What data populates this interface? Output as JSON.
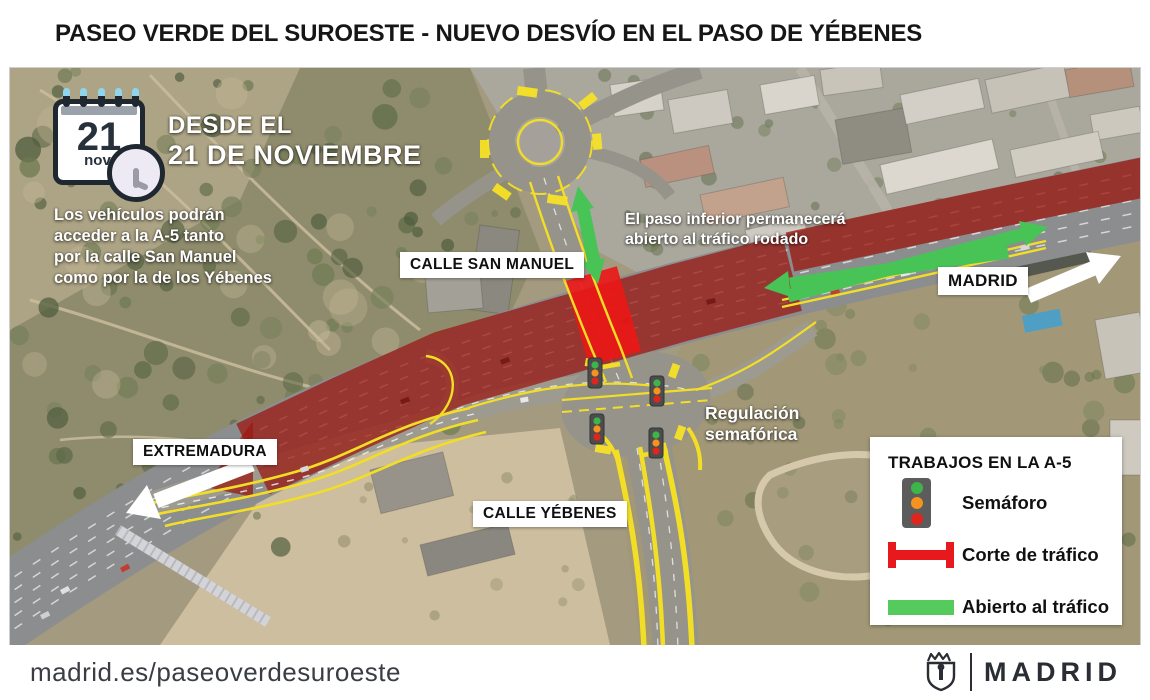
{
  "title": "PASEO VERDE DEL SUROESTE - NUEVO DESVÍO EN EL PASO DE YÉBENES",
  "calendar": {
    "day": "21",
    "month": "nov."
  },
  "date_heading": {
    "line1": "DESDE EL",
    "line2": "21 DE NOVIEMBRE"
  },
  "info_left": {
    "lines": [
      "Los vehículos podrán",
      "acceder a la A-5 tanto",
      "por la calle San Manuel",
      "como por la de los Yébenes"
    ]
  },
  "underpass_note": {
    "lines": [
      "El paso inferior permanecerá",
      "abierto al tráfico rodado"
    ]
  },
  "signal_note": {
    "lines": [
      "Regulación",
      "semafórica"
    ]
  },
  "map_labels": {
    "calle_san_manuel": "CALLE SAN MANUEL",
    "madrid": "MADRID",
    "extremadura": "EXTREMADURA",
    "calle_yebenes": "CALLE YÉBENES"
  },
  "legend": {
    "title": "TRABAJOS EN LA A-5",
    "items": [
      {
        "icon": "traffic-light-icon",
        "label": "Semáforo"
      },
      {
        "icon": "road-closed-bar-icon",
        "label": "Corte de tráfico"
      },
      {
        "icon": "open-traffic-bar-icon",
        "label": "Abierto al tráfico"
      }
    ]
  },
  "footer": {
    "url": "madrid.es/paseoverdesuroeste",
    "logo_text": "MADRID"
  },
  "colors": {
    "closure_red": "#ec1717",
    "works_overlay_red": "#9b1912",
    "open_green": "#47c455",
    "marking_yellow": "#f3de26"
  }
}
